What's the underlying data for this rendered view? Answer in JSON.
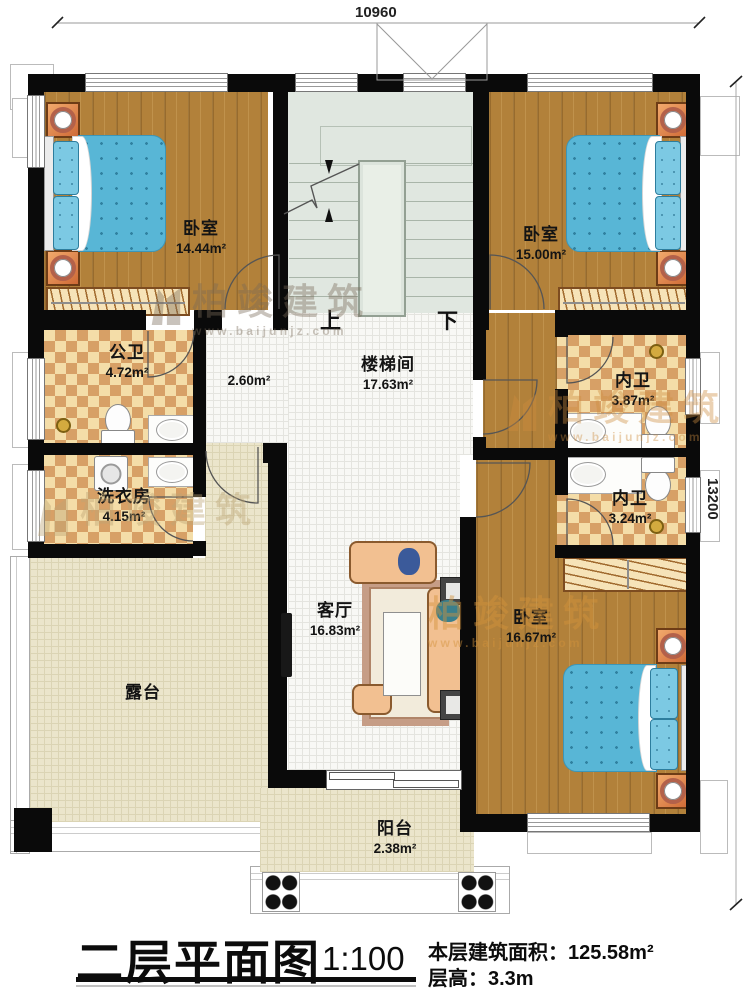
{
  "dimensions": {
    "top_width": "10960",
    "right_height": "13200"
  },
  "stairs": {
    "up": "上",
    "down": "下"
  },
  "rooms": {
    "bedroom_top_left": {
      "name": "卧室",
      "area": "14.44m²"
    },
    "bedroom_top_right": {
      "name": "卧室",
      "area": "15.00m²"
    },
    "bedroom_bottom_right": {
      "name": "卧室",
      "area": "16.67m²"
    },
    "stairwell": {
      "name": "楼梯间",
      "area": "17.63m²"
    },
    "hall": {
      "area": "2.60m²"
    },
    "public_bathroom": {
      "name": "公卫",
      "area": "4.72m²"
    },
    "ensuite_bathroom_upper": {
      "name": "内卫",
      "area": "3.87m²"
    },
    "ensuite_bathroom_lower": {
      "name": "内卫",
      "area": "3.24m²"
    },
    "laundry_room": {
      "name": "洗衣房",
      "area": "4.15m²"
    },
    "living_room": {
      "name": "客厅",
      "area": "16.83m²"
    },
    "terrace": {
      "name": "露台"
    },
    "balcony": {
      "name": "阳台",
      "area": "2.38m²"
    }
  },
  "title_block": {
    "title": "二层平面图",
    "scale": "1:100",
    "floor_area_label": "本层建筑面积：",
    "floor_area_value": "125.58m²",
    "floor_height_label": "层高：",
    "floor_height_value": "3.3m"
  },
  "watermark": {
    "brand": "柏竣建筑",
    "url": "www.baijunjz.com"
  },
  "colors": {
    "wall": "#0a0a0a",
    "wood": "#b2813a",
    "tile_accent": "#d7a066",
    "stair": "#e0e7e0",
    "bed": "#58b6d6",
    "nightstand": "#e0854a"
  }
}
